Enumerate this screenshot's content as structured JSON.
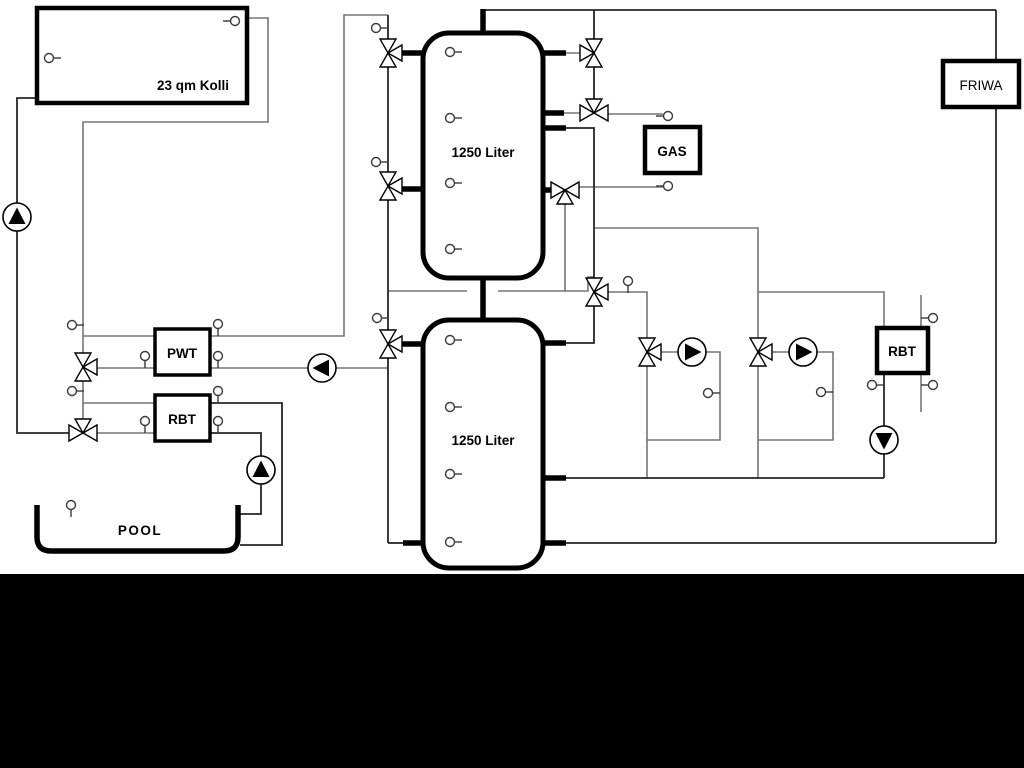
{
  "labels": {
    "collector": "23 qm Kolli",
    "tank_top": "1250 Liter",
    "tank_bottom": "1250 Liter",
    "pwt": "PWT",
    "rbt_left": "RBT",
    "gas": "GAS",
    "friwa": "FRIWA",
    "rbt_right": "RBT",
    "pool": "POOL"
  },
  "colors": {
    "pipe_gray": "#767676",
    "pipe_dark": "#262626",
    "component_stroke": "#000000",
    "background": "#ffffff",
    "bottom_bar": "#000000"
  }
}
